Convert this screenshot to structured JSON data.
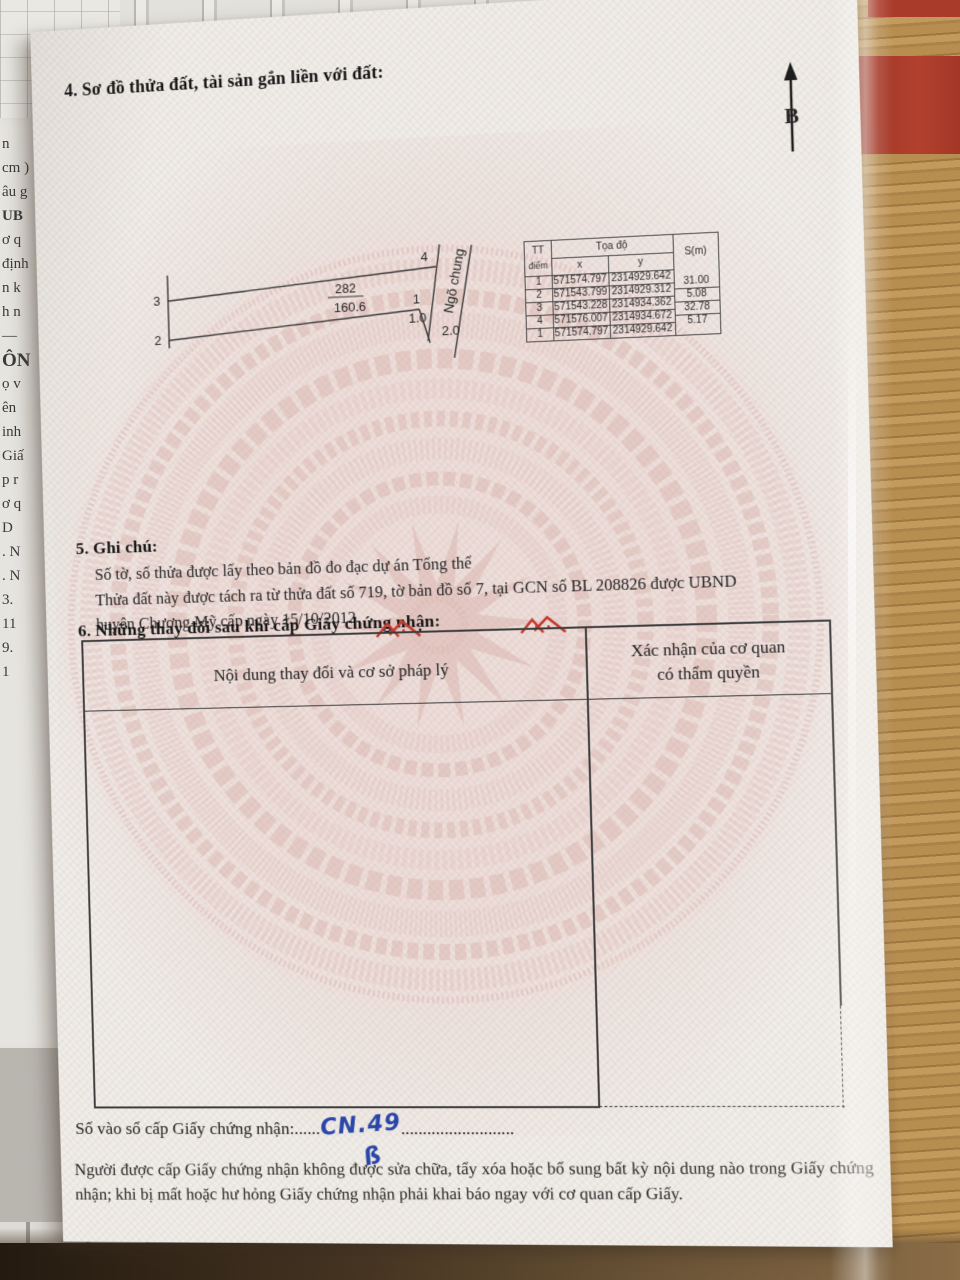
{
  "doc": {
    "section4_title": "4. Sơ đồ thửa đất, tài sản gắn liền với đất:",
    "north_label": "B",
    "diagram": {
      "parcel_number": "282",
      "area": "160.6",
      "alley": "Ngõ chung",
      "corner_top_left": "3",
      "corner_top_right": "4",
      "corner_right": "1",
      "corner_bottom_left": "2",
      "dim_a": "1.0",
      "dim_b": "2.0"
    },
    "coord_table": {
      "tt_line1": "TT",
      "tt_line2": "điểm",
      "toado": "Tọa độ",
      "x": "x",
      "y": "y",
      "s": "S(m)",
      "rows": [
        {
          "tt": "1",
          "x": "571574.797",
          "y": "2314929.642"
        },
        {
          "tt": "2",
          "x": "571543.799",
          "y": "2314929.312"
        },
        {
          "tt": "3",
          "x": "571543.228",
          "y": "2314934.362"
        },
        {
          "tt": "4",
          "x": "571576.007",
          "y": "2314934.672"
        },
        {
          "tt": "1",
          "x": "571574.797",
          "y": "2314929.642"
        }
      ],
      "s_values": [
        "31.00",
        "5.08",
        "32.78",
        "5.17"
      ]
    },
    "section5_title": "5. Ghi chú:",
    "notes": {
      "line1": "Số tờ, số thửa được lấy theo bản đồ đo đạc dự án Tổng thể",
      "line2": "Thửa đất này được tách ra từ thửa đất số 719, tờ bản đồ số 7, tại GCN số BL 208826 được UBND",
      "line3": "huyện Chương Mỹ cấp ngày 15/10/2012"
    },
    "section6_title": "6. Những thay đổi sau khi cấp Giấy chứng nhận:",
    "changes_table": {
      "col1_header": "Nội dung thay đổi và cơ sở pháp lý",
      "col2_header_line1": "Xác nhận của cơ quan",
      "col2_header_line2": "có thẩm quyền"
    },
    "serial": {
      "label": "Số vào sổ cấp Giấy chứng nhận:",
      "dots_before": "......",
      "value": "CN.49",
      "dots_after": "..........................",
      "flourish": "ß"
    },
    "footer_text": "Người được cấp Giấy chứng nhận không được sửa chữa, tẩy xóa hoặc bổ sung bất kỳ nội dung nào trong Giấy chứng nhận; khi bị mất hoặc hư hỏng Giấy chứng nhận phải khai báo ngay với cơ quan cấp Giấy."
  },
  "scene": {
    "left_paper_fragments": [
      "n",
      "cm )",
      "âu g",
      "UB",
      "ơ q",
      "định",
      "n k",
      "h n",
      "—",
      "ÔN",
      "ọ v",
      "ên",
      "inh",
      "Giấ",
      "p r",
      "ơ q",
      "D",
      ". N",
      ". N",
      "3.",
      "11",
      "9.",
      "1"
    ]
  },
  "colors": {
    "page": "#f0ede8",
    "pattern_pink": "#e2b8b4",
    "ink": "#222222",
    "handwriting_blue": "#2a46a8",
    "logo_red": "#c43a2e",
    "wood": "#ab8046",
    "red_cloth": "#a93b2b"
  }
}
